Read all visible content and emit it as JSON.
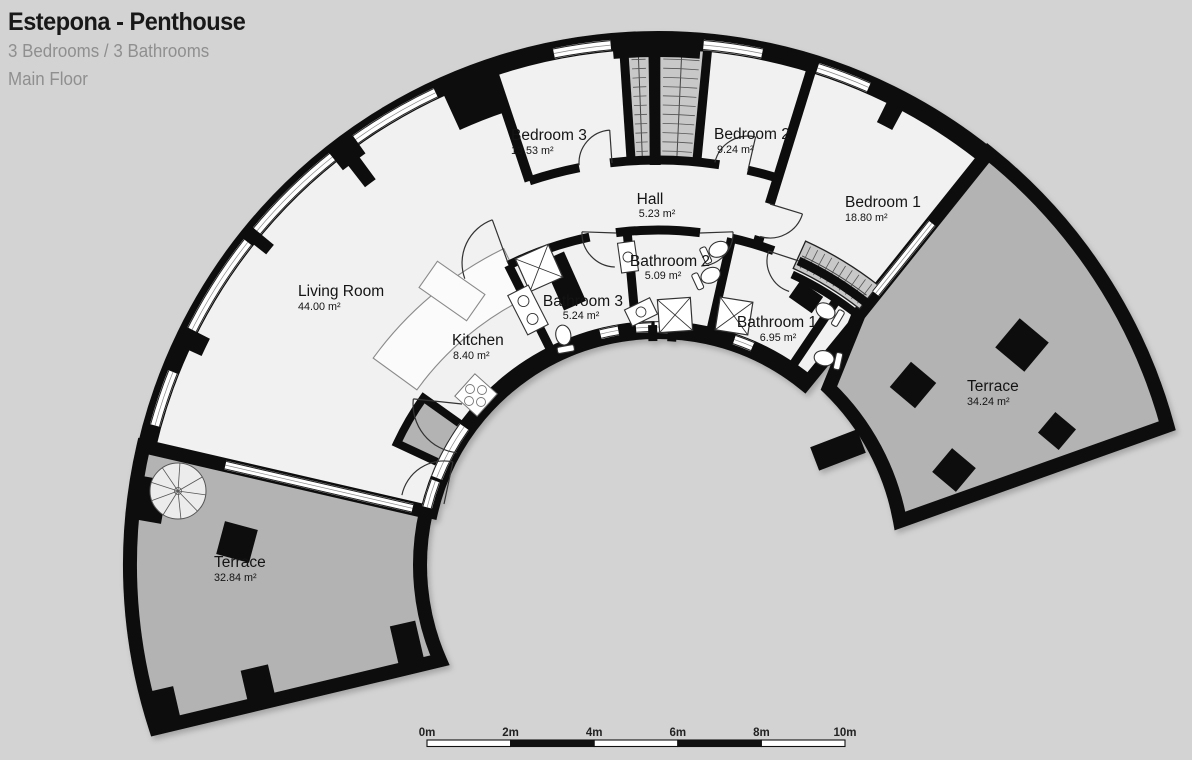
{
  "header": {
    "title": "Estepona - Penthouse",
    "subtitle": "3 Bedrooms / 3 Bathrooms",
    "floor": "Main Floor"
  },
  "rooms": [
    {
      "id": "living-room",
      "label": "Living Room",
      "area": "44.00 m²"
    },
    {
      "id": "kitchen",
      "label": "Kitchen",
      "area": "8.40 m²"
    },
    {
      "id": "bathroom-3",
      "label": "Bathroom 3",
      "area": "5.24 m²"
    },
    {
      "id": "hall",
      "label": "Hall",
      "area": "5.23 m²"
    },
    {
      "id": "bathroom-2",
      "label": "Bathroom 2",
      "area": "5.09 m²"
    },
    {
      "id": "bedroom-3",
      "label": "Bedroom 3",
      "area": "13.53 m²"
    },
    {
      "id": "bedroom-2",
      "label": "Bedroom 2",
      "area": "9.24 m²"
    },
    {
      "id": "bedroom-1",
      "label": "Bedroom 1",
      "area": "18.80 m²"
    },
    {
      "id": "bathroom-1",
      "label": "Bathroom 1",
      "area": "6.95 m²"
    },
    {
      "id": "terrace-right",
      "label": "Terrace",
      "area": "34.24 m²"
    },
    {
      "id": "terrace-left",
      "label": "Terrace",
      "area": "32.84 m²"
    }
  ],
  "scale_bar": {
    "labels": [
      "0m",
      "2m",
      "4m",
      "6m",
      "8m",
      "10m"
    ]
  },
  "colors": {
    "background": "#d3d3d3",
    "indoor": "#f1f1f1",
    "terrace": "#b3b3b3",
    "wall": "#111111",
    "window": "#ffffff",
    "wardrobe": "#c8c8c8"
  }
}
